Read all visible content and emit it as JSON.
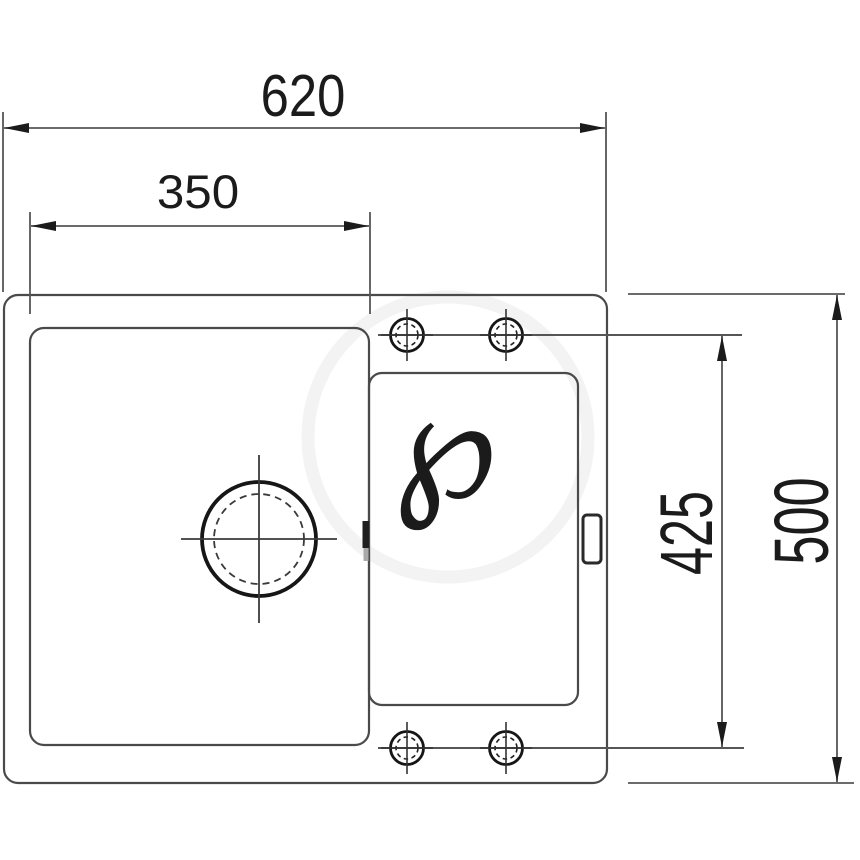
{
  "page": {
    "background": "#ffffff",
    "description": "Technical installation drawing of a one-bowl kitchen sink with drainboard, top view, with outer and cut-out dimensions"
  },
  "drawing": {
    "type": "technical-drawing",
    "subject": "kitchen-sink-top-view",
    "dimensions": {
      "overall_width": "620",
      "bowl_width": "350",
      "tap_hole_span": "425",
      "overall_depth": "500"
    },
    "watermark": {
      "glyph": "℘"
    },
    "colors": {
      "outline": "#4a4a4a",
      "dimension_line": "#565656",
      "text": "#1b1b1b",
      "detail_black": "#161616",
      "watermark": "#f2f2f2"
    }
  }
}
